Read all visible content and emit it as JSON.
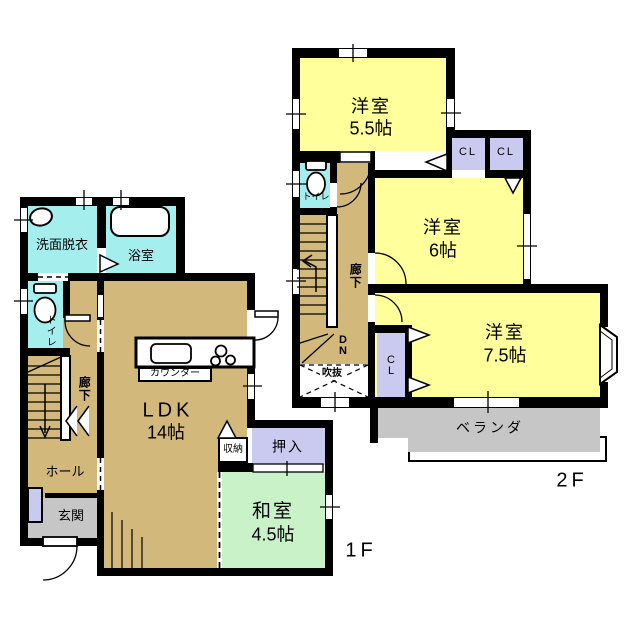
{
  "plan": {
    "floors": {
      "f1": {
        "tag": "1F",
        "rooms": {
          "senmen": {
            "name": "洗面脱衣"
          },
          "bath": {
            "name": "浴室"
          },
          "toilet": {
            "name": "トイレ"
          },
          "rouka": {
            "name": "廊下"
          },
          "hall": {
            "name": "ホール"
          },
          "genkan": {
            "name": "玄関"
          },
          "ldk": {
            "name": "LDK",
            "size": "14帖"
          },
          "counter": {
            "name": "カウンター"
          },
          "shuno": {
            "name": "収納"
          },
          "oshiire": {
            "name": "押入"
          },
          "washitsu": {
            "name": "和室",
            "size": "4.5帖"
          }
        }
      },
      "f2": {
        "tag": "2F",
        "rooms": {
          "yoshitsu_a": {
            "name": "洋室",
            "size": "5.5帖"
          },
          "toilet": {
            "name": "トイレ"
          },
          "rouka": {
            "name": "廊下"
          },
          "closet_a": {
            "name": "CL"
          },
          "closet_b": {
            "name": "CL"
          },
          "closet_c": {
            "name": "CL"
          },
          "yoshitsu_b": {
            "name": "洋室",
            "size": "6帖"
          },
          "yoshitsu_c": {
            "name": "洋室",
            "size": "7.5帖"
          },
          "stairs_dn": {
            "name": "DN"
          },
          "fukinuke": {
            "name": "吹抜"
          },
          "veranda": {
            "name": "ベランダ"
          }
        }
      }
    },
    "colors": {
      "wall": "#000000",
      "western_room": "#FFFF9C",
      "wet_area": "#A5EEEE",
      "flooring": "#D2B87B",
      "tatami": "#C9F2C8",
      "closet": "#CACAF0",
      "concrete": "#C6C6C6"
    }
  }
}
